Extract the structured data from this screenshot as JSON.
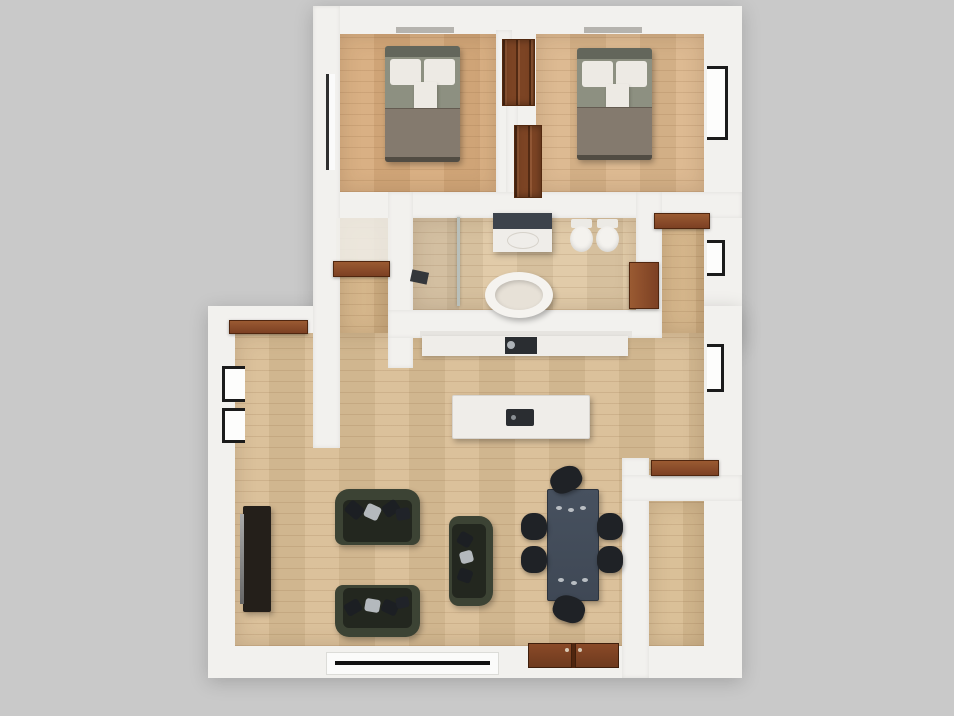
{
  "scene": {
    "kind": "floor-plan-3d-render",
    "view": "top-down",
    "visible_text": "none"
  },
  "colors": {
    "background": "#c9c9c9",
    "wall": "#f2f1ee",
    "floorBedroomLeft": "#d7ab7c",
    "floorBedroomRight": "#dbb68b",
    "floorBath": "#dfc8a4",
    "floorLiving": "#d9bd95",
    "floorHall": "#d2b184",
    "floorEntry": "#d8bc92",
    "closet": "#7c4424",
    "door": "#7c4023",
    "doorLight": "#9a5a32",
    "doorDark": "#50260f",
    "bedHeadboard": "#63665b",
    "bedDuvet": "#8d9081",
    "bedDuvetLower": "#847a6e",
    "bedPillow": "#edeae4",
    "sofa": "#3c4334",
    "sofaSeat": "#23271f",
    "cushionDark": "#1c1f23",
    "cushionLight": "#b4b9bd",
    "tvConsole": "#241f1a",
    "tvScreen": "#909090",
    "table": "#3f4855",
    "chair": "#1f2226",
    "counter": "#efede9",
    "appliance": "#2a2d31",
    "tubInner": "#e7e1d7",
    "vanityTop": "#3d434c",
    "glass": "#b9c0bb",
    "frame": "#1b1b1b"
  },
  "rooms": [
    {
      "id": "bedroom-left",
      "label": "Bedroom"
    },
    {
      "id": "bedroom-right",
      "label": "Bedroom"
    },
    {
      "id": "bathroom",
      "label": "Bathroom"
    },
    {
      "id": "kitchen",
      "label": "Kitchen"
    },
    {
      "id": "living-dining",
      "label": "Living / Dining Room"
    },
    {
      "id": "hallway",
      "label": "Hallway"
    },
    {
      "id": "entry",
      "label": "Entry"
    }
  ],
  "furniture": [
    {
      "id": "bed-left",
      "label": "Double bed"
    },
    {
      "id": "bed-right",
      "label": "Double bed"
    },
    {
      "id": "wardrobe-left",
      "label": "Built-in wardrobe"
    },
    {
      "id": "wardrobe-right",
      "label": "Built-in wardrobe"
    },
    {
      "id": "bathroom-vanity",
      "label": "Vanity with dark countertop"
    },
    {
      "id": "toilet-1",
      "label": "Toilet"
    },
    {
      "id": "toilet-2",
      "label": "Bidet"
    },
    {
      "id": "bathtub",
      "label": "Freestanding oval bathtub"
    },
    {
      "id": "shower",
      "label": "Walk-in shower with glass panel"
    },
    {
      "id": "kitchen-counter",
      "label": "Kitchen counter with cooktop"
    },
    {
      "id": "kitchen-island",
      "label": "Kitchen island with sink"
    },
    {
      "id": "sofa-top",
      "label": "Dark green sofa"
    },
    {
      "id": "sofa-bottom",
      "label": "Dark green sofa"
    },
    {
      "id": "loveseat",
      "label": "Dark green loveseat"
    },
    {
      "id": "tv-console",
      "label": "TV media console"
    },
    {
      "id": "dining-table",
      "label": "Dining table (dark)"
    },
    {
      "id": "dining-chairs",
      "label": "Dining chair",
      "count": 6
    }
  ],
  "openings": [
    {
      "id": "entry-door-double",
      "label": "Double entry door (wood)"
    },
    {
      "id": "door-bedroom-left",
      "label": "Bedroom door (open leaf)"
    },
    {
      "id": "door-bedroom-right",
      "label": "Bedroom door (open leaf)"
    },
    {
      "id": "door-bathroom",
      "label": "Bathroom door"
    },
    {
      "id": "door-living-topleft",
      "label": "Side door (open leaf)"
    },
    {
      "id": "door-entry-room",
      "label": "Entry room door (open leaf)"
    },
    {
      "id": "window-bottom-large",
      "label": "Large window"
    },
    {
      "id": "window-left-1",
      "label": "Window"
    },
    {
      "id": "window-left-2",
      "label": "Window"
    },
    {
      "id": "window-right-bedroom",
      "label": "Window"
    },
    {
      "id": "window-right-1",
      "label": "Window"
    },
    {
      "id": "window-right-2",
      "label": "Window"
    },
    {
      "id": "window-bedroom-left-side",
      "label": "Narrow side window"
    }
  ]
}
